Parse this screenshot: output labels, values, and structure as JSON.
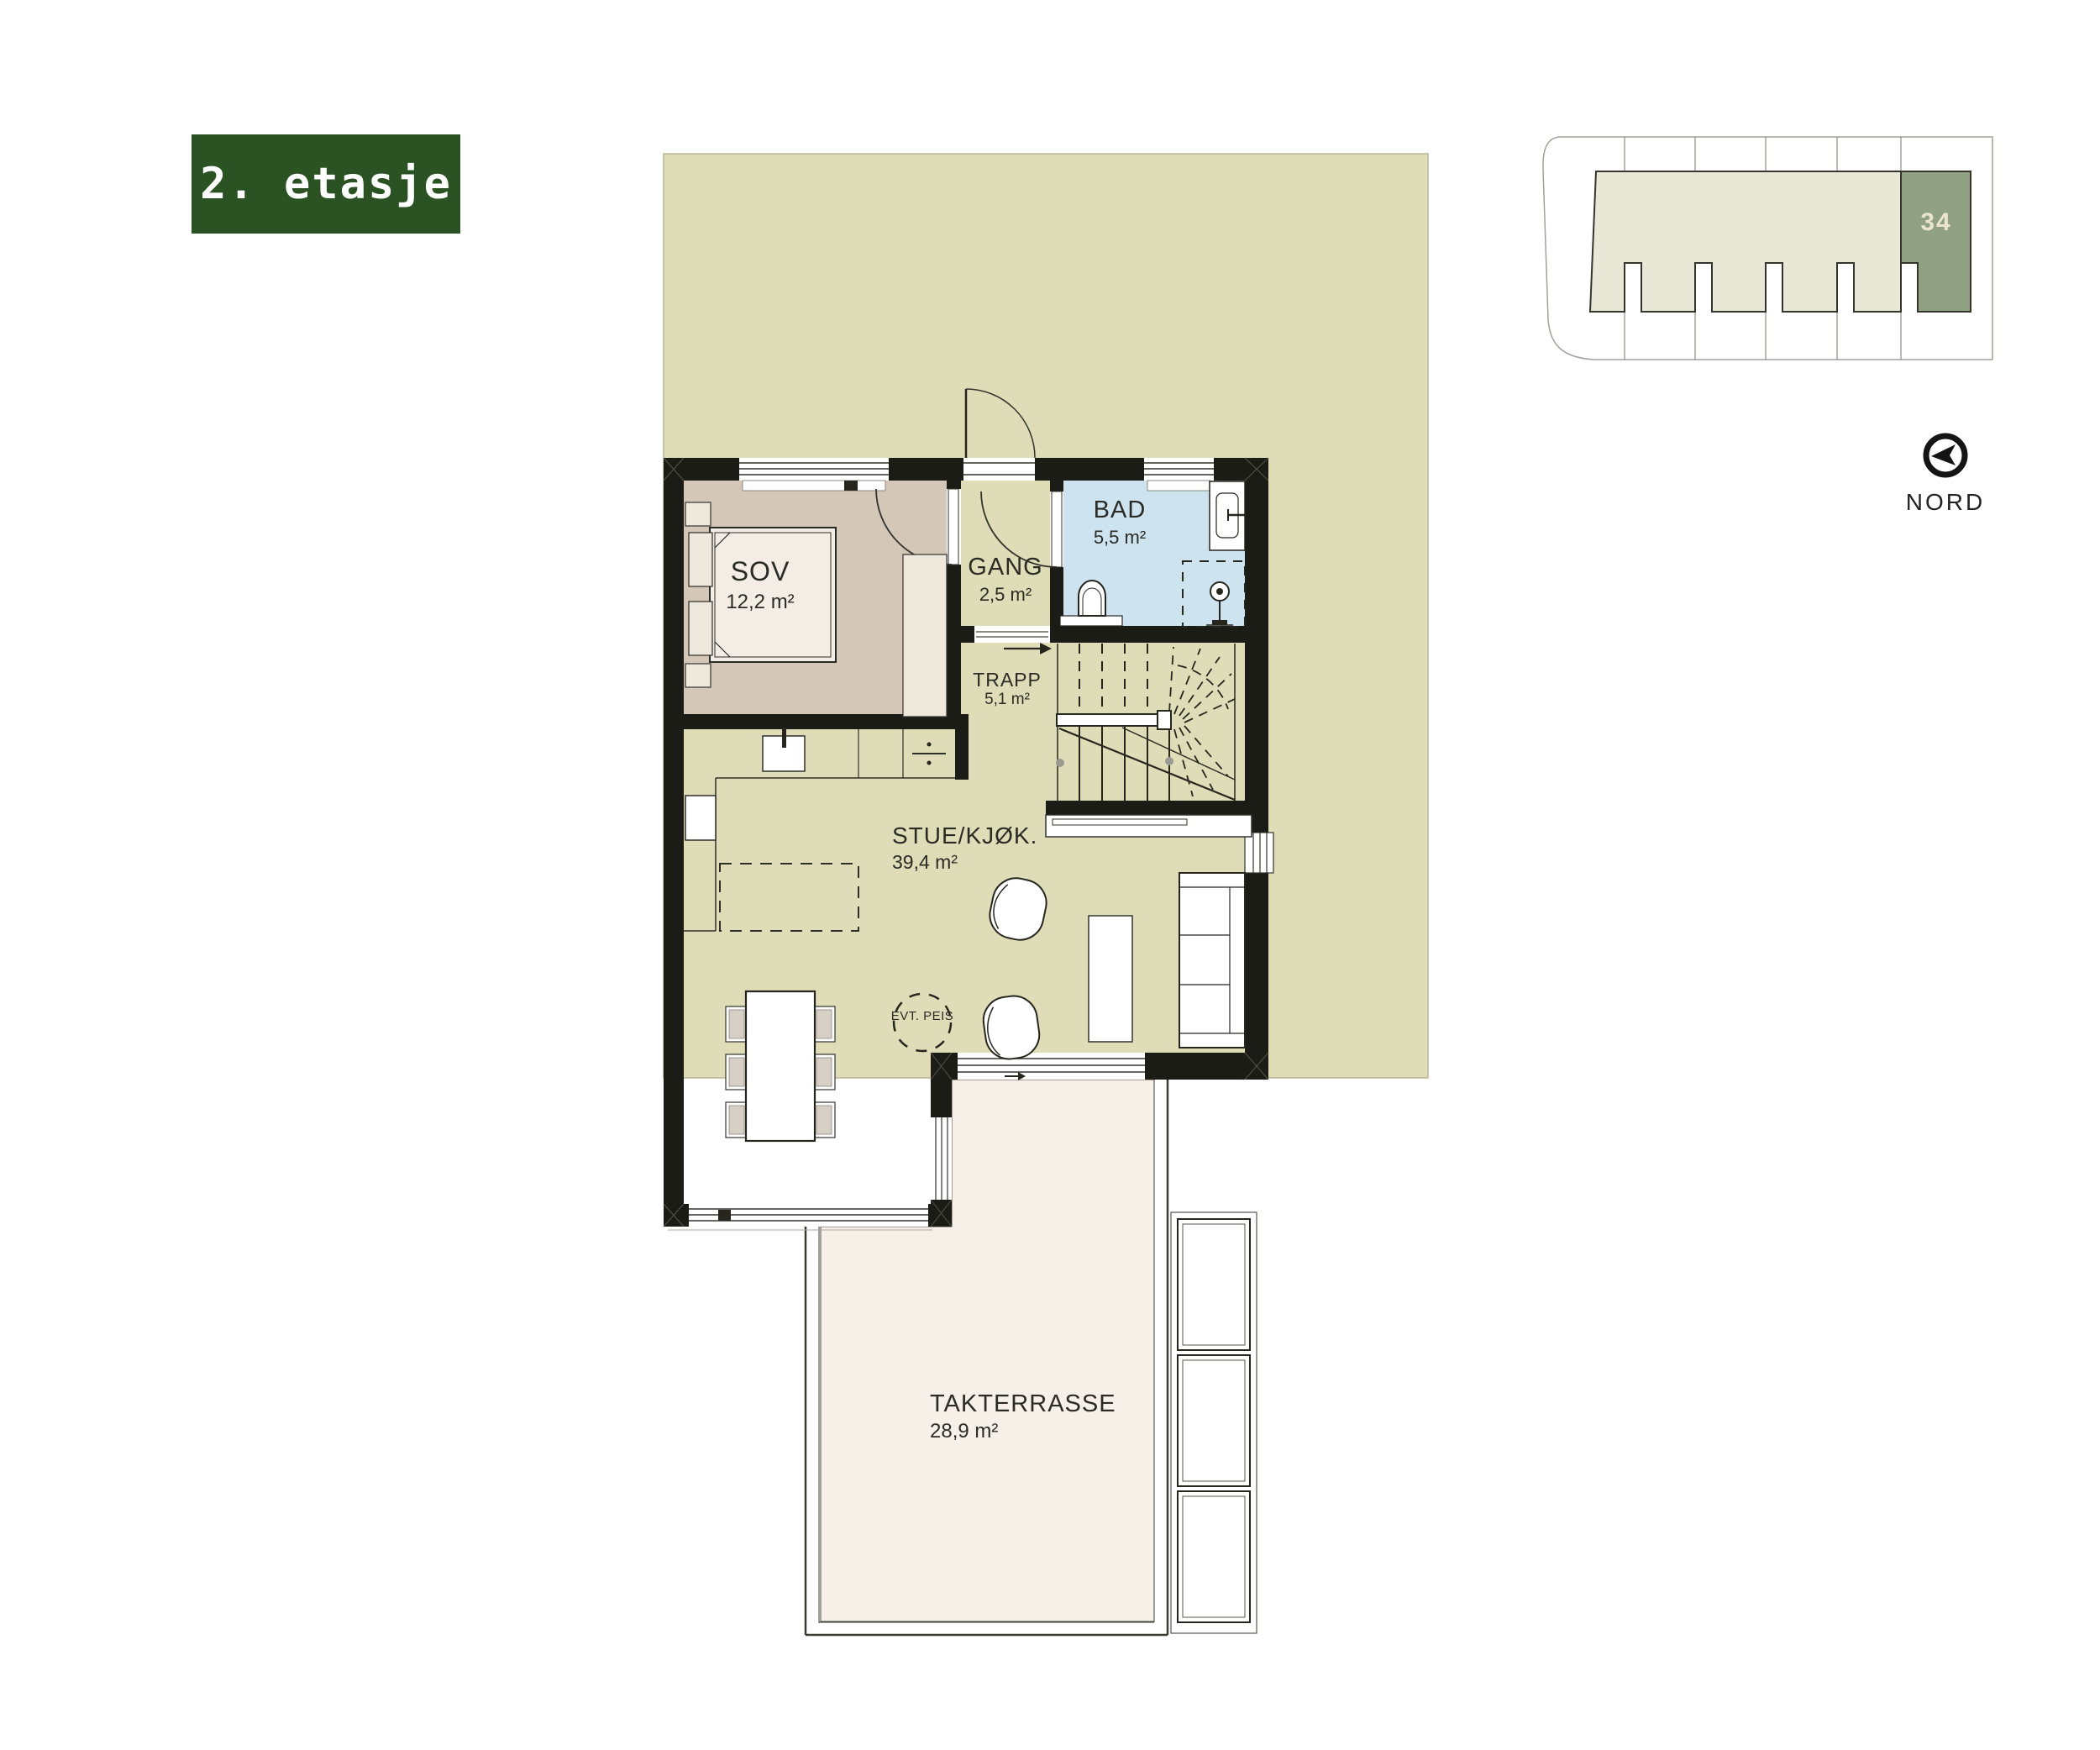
{
  "floor_label": "2. etasje",
  "site_plan": {
    "highlighted_unit": "34"
  },
  "compass": {
    "label": "NORD"
  },
  "rooms": {
    "sov": {
      "name": "SOV",
      "area": "12,2 m²"
    },
    "gang": {
      "name": "GANG",
      "area": "2,5 m²"
    },
    "bad": {
      "name": "BAD",
      "area": "5,5 m²"
    },
    "trapp": {
      "name": "TRAPP",
      "area": "5,1 m²"
    },
    "stue": {
      "name": "STUE/KJØK.",
      "area": "39,4 m²"
    },
    "terrace": {
      "name": "TAKTERRASSE",
      "area": "28,9 m²"
    }
  },
  "annotations": {
    "fireplace": "EVT. PEIS"
  },
  "colors": {
    "accent_green": "#2a5223",
    "unit_highlight": "#90a283",
    "site_footprint": "#e9e7d5",
    "garden": "#deddb7",
    "bedroom": "#d5c7b8",
    "bathroom": "#cde4f0",
    "terrace_floor": "#f7f0e8",
    "furniture_cream": "#efe8dd",
    "wall": "#1c1c17"
  }
}
